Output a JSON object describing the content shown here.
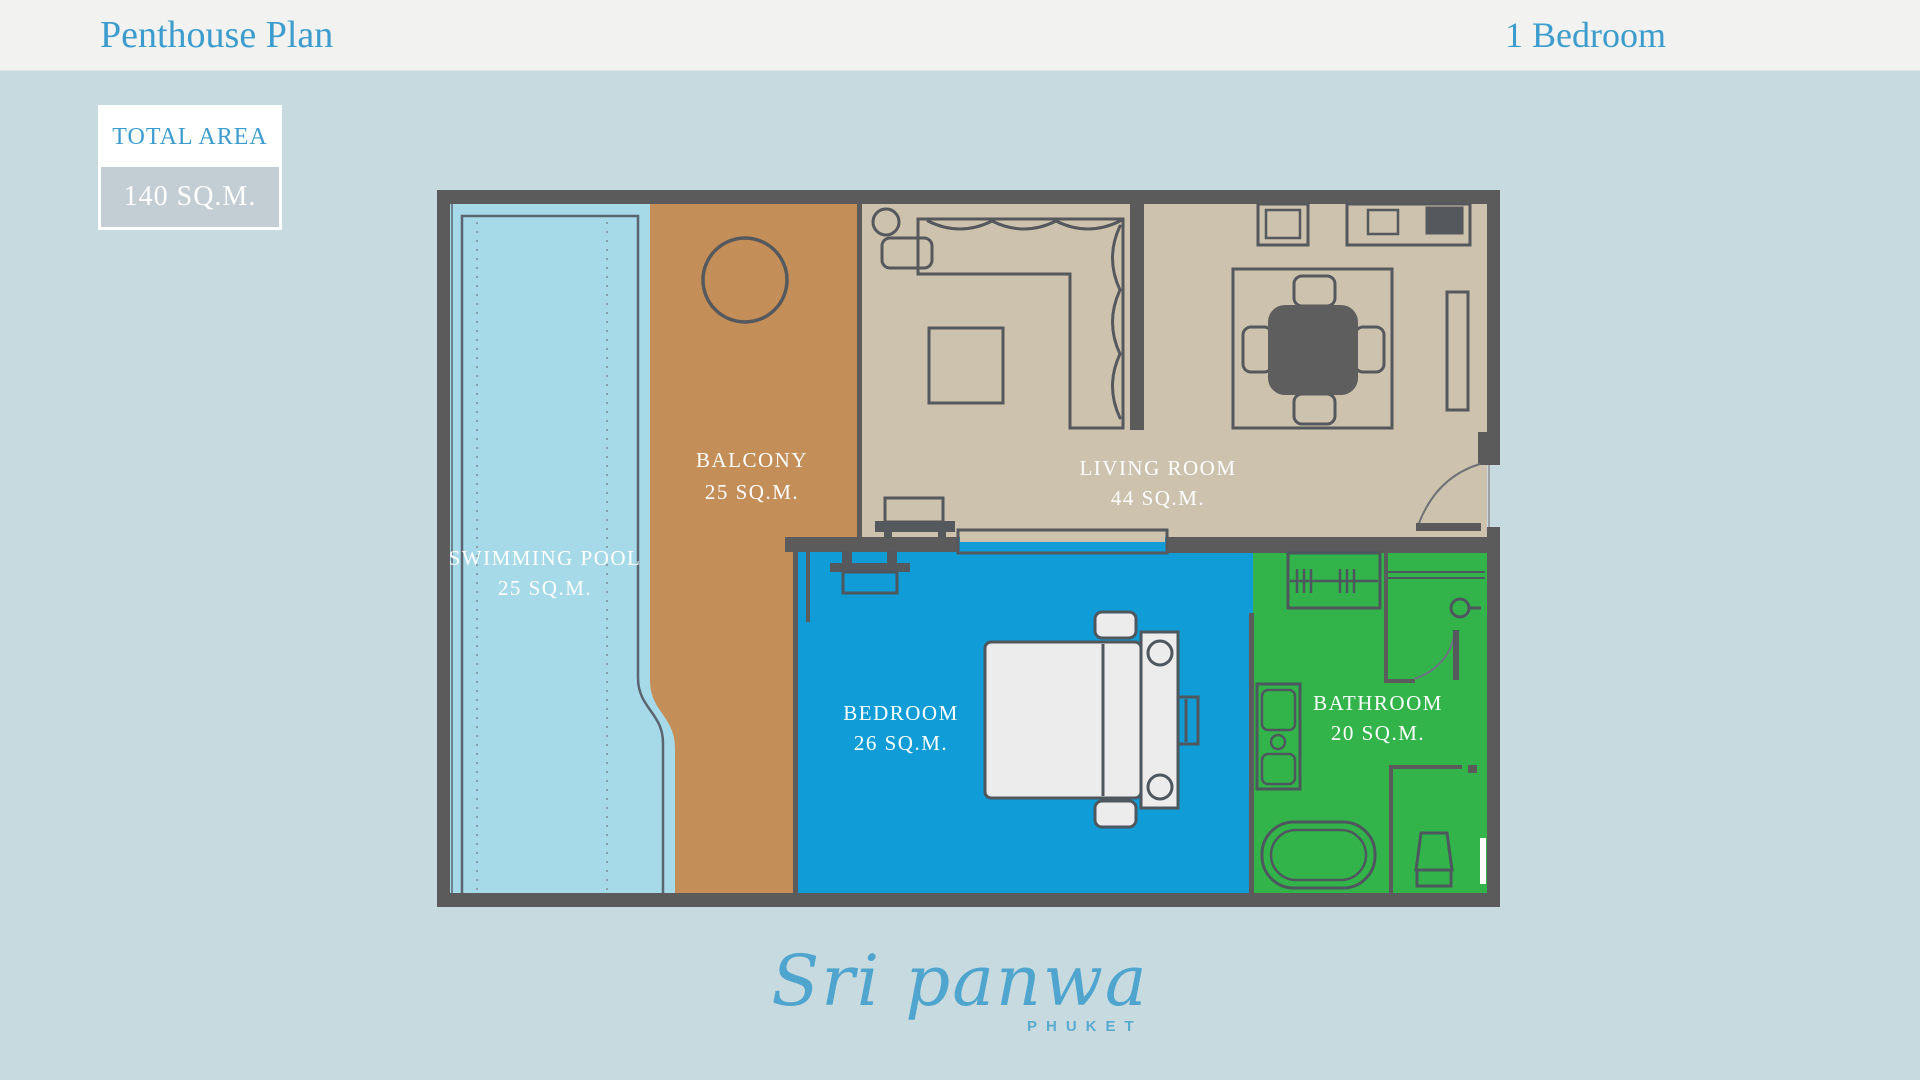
{
  "header": {
    "title": "Penthouse Plan",
    "subtitle": "1 Bedroom"
  },
  "total_area": {
    "label": "TOTAL AREA",
    "value": "140 SQ.M."
  },
  "rooms": [
    {
      "id": "swimming-pool",
      "name": "SWIMMING POOL",
      "area": "25 SQ.M.",
      "color": "#a6dae9"
    },
    {
      "id": "balcony",
      "name": "BALCONY",
      "area": "25 SQ.M.",
      "color": "#c48e58"
    },
    {
      "id": "living-room",
      "name": "LIVING ROOM",
      "area": "44 SQ.M.",
      "color": "#cdc2ad"
    },
    {
      "id": "bedroom",
      "name": "BEDROOM",
      "area": "26 SQ.M.",
      "color": "#109dd7"
    },
    {
      "id": "bathroom",
      "name": "BATHROOM",
      "area": "20 SQ.M.",
      "color": "#33b44a"
    }
  ],
  "brand": {
    "name": "Sri panwa",
    "location": "PHUKET"
  },
  "colors": {
    "background": "#c6dae0",
    "header_background": "#f2f2f0",
    "accent_blue": "#3b9ccd",
    "wall": "#5b5b5b",
    "furniture_line": "#55585c",
    "bed_fill": "#ececec",
    "total_area_value_bg": "#c3cdd4",
    "logo_blue": "#4fa5cd"
  }
}
